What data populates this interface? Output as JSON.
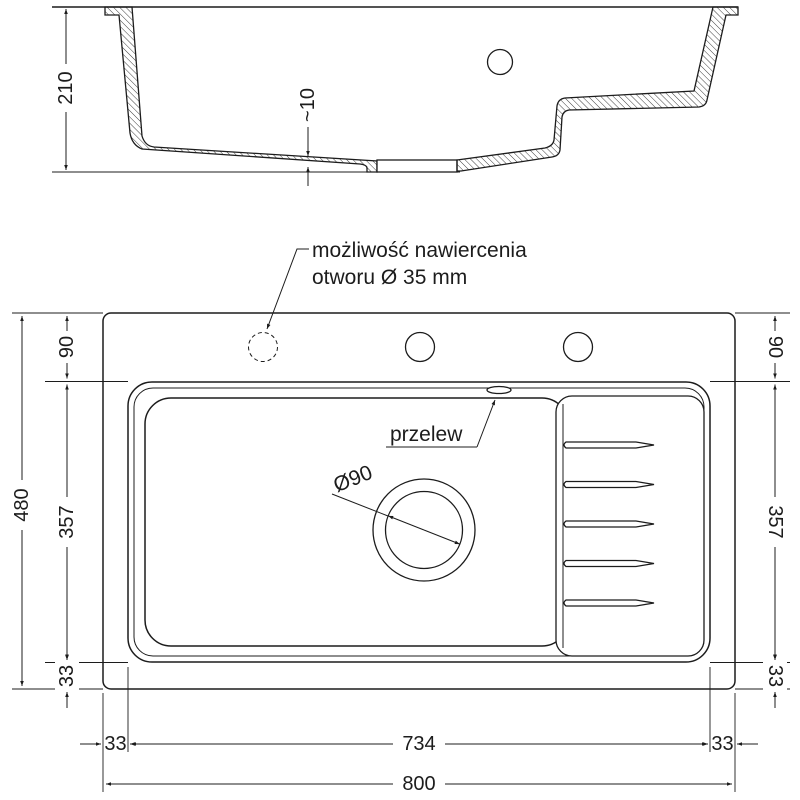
{
  "side_view": {
    "height": "210",
    "bottom_thickness": "~10"
  },
  "top_view": {
    "drill_note_line1": "możliwość nawiercenia",
    "drill_note_line2": "otworu Ø 35 mm",
    "overflow_label": "przelew",
    "drain_diameter": "Ø90",
    "dims_left": {
      "deck": "90",
      "basin_depth": "357",
      "bottom_margin": "33",
      "overall": "480"
    },
    "dims_right": {
      "deck": "90",
      "basin_depth": "357",
      "bottom_margin": "33"
    },
    "dims_bottom": {
      "left_margin": "33",
      "basin_width": "734",
      "right_margin": "33",
      "overall": "800"
    }
  },
  "colors": {
    "line": "#1c1c1c",
    "bg": "#ffffff"
  }
}
